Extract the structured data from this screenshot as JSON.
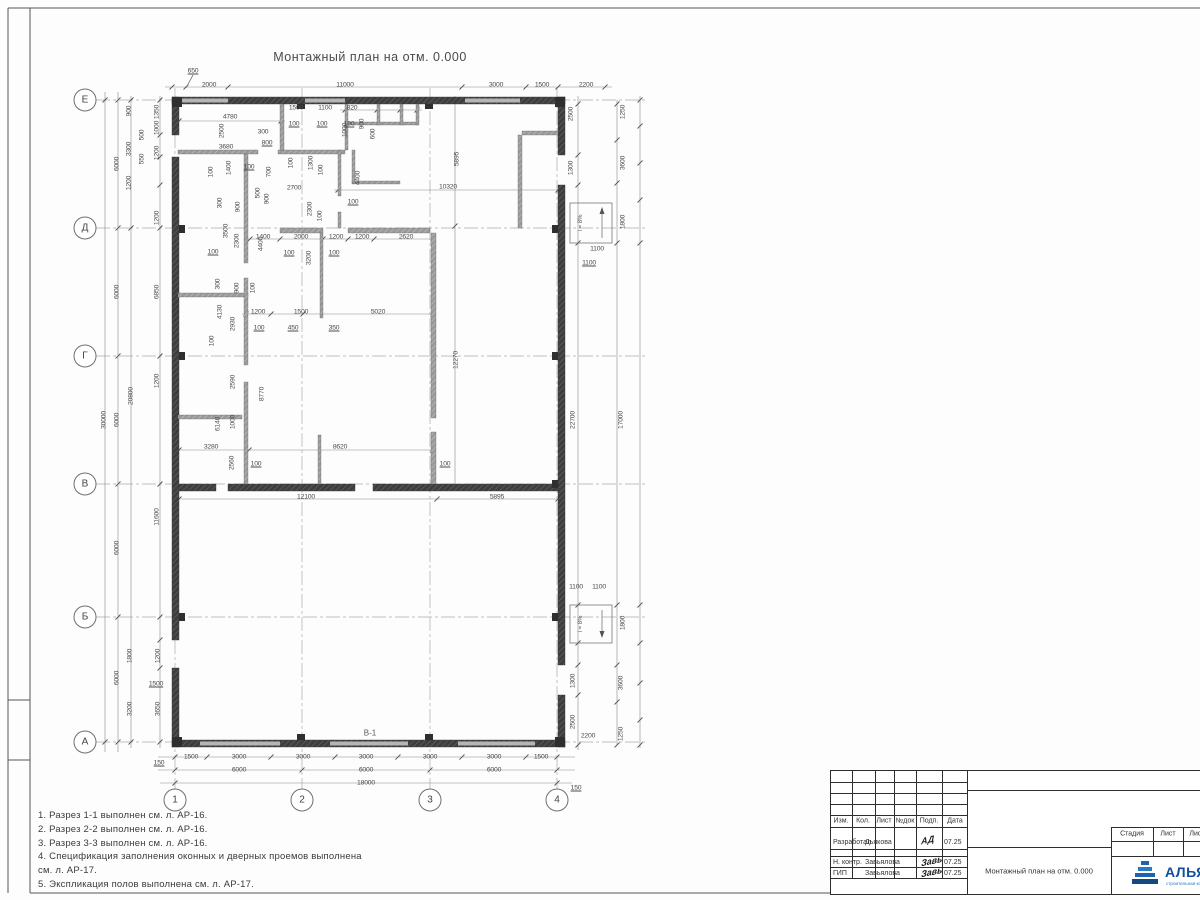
{
  "title": "Монтажный план на отм. 0.000",
  "plan_label": "В-1",
  "ramps": {
    "top": "i = 8%",
    "bottom": "i = 8%"
  },
  "grid": {
    "rows": [
      {
        "label": "Е",
        "y": 100
      },
      {
        "label": "Д",
        "y": 228
      },
      {
        "label": "Г",
        "y": 356
      },
      {
        "label": "В",
        "y": 484
      },
      {
        "label": "Б",
        "y": 617
      },
      {
        "label": "А",
        "y": 742
      }
    ],
    "cols": [
      {
        "label": "1",
        "x": 175
      },
      {
        "label": "2",
        "x": 302
      },
      {
        "label": "3",
        "x": 430
      },
      {
        "label": "4",
        "x": 557
      }
    ]
  },
  "dims": [
    {
      "t": "650",
      "x": 193,
      "y": 71,
      "r": 0,
      "u": 1
    },
    {
      "t": "2000",
      "x": 209,
      "y": 85,
      "r": 0
    },
    {
      "t": "11000",
      "x": 345,
      "y": 85,
      "r": 0
    },
    {
      "t": "3000",
      "x": 496,
      "y": 85,
      "r": 0
    },
    {
      "t": "1500",
      "x": 542,
      "y": 85,
      "r": 0
    },
    {
      "t": "2200",
      "x": 586,
      "y": 85,
      "r": 0
    },
    {
      "t": "1500",
      "x": 296,
      "y": 108,
      "r": 0
    },
    {
      "t": "1100",
      "x": 325,
      "y": 108,
      "r": 0
    },
    {
      "t": "820",
      "x": 352,
      "y": 108,
      "r": 0
    },
    {
      "t": "4780",
      "x": 230,
      "y": 117,
      "r": 0
    },
    {
      "t": "100",
      "x": 294,
      "y": 124,
      "r": 0,
      "u": 1
    },
    {
      "t": "100",
      "x": 322,
      "y": 124,
      "r": 0,
      "u": 1
    },
    {
      "t": "100",
      "x": 349,
      "y": 124,
      "r": 0,
      "u": 1
    },
    {
      "t": "900",
      "x": 362,
      "y": 124,
      "r": 1
    },
    {
      "t": "600",
      "x": 373,
      "y": 134,
      "r": 1
    },
    {
      "t": "2500",
      "x": 222,
      "y": 131,
      "r": 1
    },
    {
      "t": "300",
      "x": 263,
      "y": 132,
      "r": 0
    },
    {
      "t": "800",
      "x": 267,
      "y": 143,
      "r": 0,
      "u": 1
    },
    {
      "t": "3680",
      "x": 226,
      "y": 147,
      "r": 0
    },
    {
      "t": "1000",
      "x": 345,
      "y": 130,
      "r": 1
    },
    {
      "t": "100",
      "x": 291,
      "y": 163,
      "r": 1
    },
    {
      "t": "1300",
      "x": 311,
      "y": 163,
      "r": 1
    },
    {
      "t": "100",
      "x": 321,
      "y": 170,
      "r": 1
    },
    {
      "t": "4400",
      "x": 358,
      "y": 178,
      "r": 1
    },
    {
      "t": "5895",
      "x": 457,
      "y": 159,
      "r": 1
    },
    {
      "t": "10320",
      "x": 448,
      "y": 187,
      "r": 0
    },
    {
      "t": "100",
      "x": 211,
      "y": 172,
      "r": 1
    },
    {
      "t": "1400",
      "x": 229,
      "y": 168,
      "r": 1
    },
    {
      "t": "100",
      "x": 249,
      "y": 167,
      "r": 0,
      "u": 1
    },
    {
      "t": "700",
      "x": 269,
      "y": 172,
      "r": 1
    },
    {
      "t": "2700",
      "x": 294,
      "y": 188,
      "r": 0
    },
    {
      "t": "100",
      "x": 353,
      "y": 202,
      "r": 0,
      "u": 1
    },
    {
      "t": "500",
      "x": 258,
      "y": 193,
      "r": 1
    },
    {
      "t": "900",
      "x": 267,
      "y": 199,
      "r": 1
    },
    {
      "t": "2300",
      "x": 310,
      "y": 209,
      "r": 1
    },
    {
      "t": "100",
      "x": 320,
      "y": 216,
      "r": 1
    },
    {
      "t": "300",
      "x": 220,
      "y": 203,
      "r": 1
    },
    {
      "t": "900",
      "x": 238,
      "y": 207,
      "r": 1
    },
    {
      "t": "3500",
      "x": 226,
      "y": 231,
      "r": 1
    },
    {
      "t": "2300",
      "x": 237,
      "y": 241,
      "r": 1
    },
    {
      "t": "1400",
      "x": 263,
      "y": 237,
      "r": 0
    },
    {
      "t": "2000",
      "x": 301,
      "y": 237,
      "r": 0
    },
    {
      "t": "1200",
      "x": 336,
      "y": 237,
      "r": 0
    },
    {
      "t": "1200",
      "x": 362,
      "y": 237,
      "r": 0
    },
    {
      "t": "2620",
      "x": 406,
      "y": 237,
      "r": 0
    },
    {
      "t": "100",
      "x": 289,
      "y": 253,
      "r": 0,
      "u": 1
    },
    {
      "t": "100",
      "x": 334,
      "y": 253,
      "r": 0,
      "u": 1
    },
    {
      "t": "100",
      "x": 213,
      "y": 252,
      "r": 0,
      "u": 1
    },
    {
      "t": "4400",
      "x": 261,
      "y": 244,
      "r": 1
    },
    {
      "t": "3200",
      "x": 309,
      "y": 258,
      "r": 1
    },
    {
      "t": "300",
      "x": 218,
      "y": 284,
      "r": 1
    },
    {
      "t": "900",
      "x": 237,
      "y": 288,
      "r": 1
    },
    {
      "t": "100",
      "x": 253,
      "y": 288,
      "r": 1
    },
    {
      "t": "4130",
      "x": 220,
      "y": 312,
      "r": 1
    },
    {
      "t": "2930",
      "x": 233,
      "y": 324,
      "r": 1
    },
    {
      "t": "1200",
      "x": 258,
      "y": 312,
      "r": 0
    },
    {
      "t": "1500",
      "x": 301,
      "y": 312,
      "r": 0
    },
    {
      "t": "5020",
      "x": 378,
      "y": 312,
      "r": 0
    },
    {
      "t": "100",
      "x": 259,
      "y": 328,
      "r": 0,
      "u": 1
    },
    {
      "t": "450",
      "x": 293,
      "y": 328,
      "r": 0,
      "u": 1
    },
    {
      "t": "350",
      "x": 334,
      "y": 328,
      "r": 0,
      "u": 1
    },
    {
      "t": "100",
      "x": 212,
      "y": 341,
      "r": 1
    },
    {
      "t": "2590",
      "x": 233,
      "y": 382,
      "r": 1
    },
    {
      "t": "8770",
      "x": 262,
      "y": 394,
      "r": 1
    },
    {
      "t": "6140",
      "x": 218,
      "y": 424,
      "r": 1
    },
    {
      "t": "1000",
      "x": 233,
      "y": 422,
      "r": 1
    },
    {
      "t": "3280",
      "x": 211,
      "y": 447,
      "r": 0
    },
    {
      "t": "8620",
      "x": 340,
      "y": 447,
      "r": 0
    },
    {
      "t": "2560",
      "x": 232,
      "y": 463,
      "r": 1
    },
    {
      "t": "100",
      "x": 256,
      "y": 464,
      "r": 0,
      "u": 1
    },
    {
      "t": "100",
      "x": 445,
      "y": 464,
      "r": 0,
      "u": 1
    },
    {
      "t": "12100",
      "x": 306,
      "y": 497,
      "r": 0
    },
    {
      "t": "5895",
      "x": 497,
      "y": 497,
      "r": 0
    },
    {
      "t": "12270",
      "x": 456,
      "y": 360,
      "r": 1
    },
    {
      "t": "30000",
      "x": 104,
      "y": 420,
      "r": 1
    },
    {
      "t": "6000",
      "x": 117,
      "y": 164,
      "r": 1
    },
    {
      "t": "6000",
      "x": 117,
      "y": 292,
      "r": 1
    },
    {
      "t": "6000",
      "x": 117,
      "y": 420,
      "r": 1
    },
    {
      "t": "6000",
      "x": 117,
      "y": 548,
      "r": 1
    },
    {
      "t": "6000",
      "x": 117,
      "y": 678,
      "r": 1
    },
    {
      "t": "900",
      "x": 129,
      "y": 111,
      "r": 1
    },
    {
      "t": "3300",
      "x": 129,
      "y": 149,
      "r": 1
    },
    {
      "t": "1200",
      "x": 129,
      "y": 183,
      "r": 1
    },
    {
      "t": "20800",
      "x": 131,
      "y": 396,
      "r": 1
    },
    {
      "t": "500",
      "x": 142,
      "y": 135,
      "r": 1
    },
    {
      "t": "550",
      "x": 142,
      "y": 159,
      "r": 1
    },
    {
      "t": "1350",
      "x": 157,
      "y": 112,
      "r": 1
    },
    {
      "t": "1000",
      "x": 157,
      "y": 128,
      "r": 1
    },
    {
      "t": "1200",
      "x": 157,
      "y": 153,
      "r": 1
    },
    {
      "t": "1200",
      "x": 157,
      "y": 218,
      "r": 1
    },
    {
      "t": "6850",
      "x": 157,
      "y": 292,
      "r": 1
    },
    {
      "t": "1200",
      "x": 157,
      "y": 381,
      "r": 1
    },
    {
      "t": "11600",
      "x": 157,
      "y": 517,
      "r": 1
    },
    {
      "t": "1800",
      "x": 130,
      "y": 656,
      "r": 1
    },
    {
      "t": "1200",
      "x": 158,
      "y": 656,
      "r": 1
    },
    {
      "t": "1500",
      "x": 156,
      "y": 684,
      "r": 0,
      "u": 1
    },
    {
      "t": "3200",
      "x": 130,
      "y": 709,
      "r": 1
    },
    {
      "t": "3650",
      "x": 158,
      "y": 709,
      "r": 1
    },
    {
      "t": "150",
      "x": 159,
      "y": 763,
      "r": 0,
      "u": 1
    },
    {
      "t": "1500",
      "x": 191,
      "y": 757,
      "r": 0
    },
    {
      "t": "3000",
      "x": 239,
      "y": 757,
      "r": 0
    },
    {
      "t": "3000",
      "x": 303,
      "y": 757,
      "r": 0
    },
    {
      "t": "3000",
      "x": 366,
      "y": 757,
      "r": 0
    },
    {
      "t": "3000",
      "x": 430,
      "y": 757,
      "r": 0
    },
    {
      "t": "3000",
      "x": 494,
      "y": 757,
      "r": 0
    },
    {
      "t": "1500",
      "x": 541,
      "y": 757,
      "r": 0
    },
    {
      "t": "6000",
      "x": 239,
      "y": 770,
      "r": 0
    },
    {
      "t": "6000",
      "x": 366,
      "y": 770,
      "r": 0
    },
    {
      "t": "6000",
      "x": 494,
      "y": 770,
      "r": 0
    },
    {
      "t": "18000",
      "x": 366,
      "y": 783,
      "r": 0
    },
    {
      "t": "150",
      "x": 576,
      "y": 788,
      "r": 0,
      "u": 1
    },
    {
      "t": "1250",
      "x": 623,
      "y": 112,
      "r": 1
    },
    {
      "t": "2500",
      "x": 571,
      "y": 114,
      "r": 1
    },
    {
      "t": "1300",
      "x": 571,
      "y": 168,
      "r": 1
    },
    {
      "t": "3600",
      "x": 623,
      "y": 163,
      "r": 1
    },
    {
      "t": "1800",
      "x": 623,
      "y": 222,
      "r": 1
    },
    {
      "t": "1100",
      "x": 597,
      "y": 249,
      "r": 0
    },
    {
      "t": "1100",
      "x": 589,
      "y": 263,
      "r": 0,
      "u": 1
    },
    {
      "t": "22700",
      "x": 573,
      "y": 420,
      "r": 1
    },
    {
      "t": "17000",
      "x": 621,
      "y": 420,
      "r": 1
    },
    {
      "t": "1100",
      "x": 576,
      "y": 587,
      "r": 0
    },
    {
      "t": "1100",
      "x": 599,
      "y": 587,
      "r": 0
    },
    {
      "t": "1800",
      "x": 623,
      "y": 623,
      "r": 1
    },
    {
      "t": "1300",
      "x": 573,
      "y": 681,
      "r": 1
    },
    {
      "t": "3600",
      "x": 621,
      "y": 683,
      "r": 1
    },
    {
      "t": "2500",
      "x": 573,
      "y": 722,
      "r": 1
    },
    {
      "t": "2200",
      "x": 588,
      "y": 736,
      "r": 0
    },
    {
      "t": "1250",
      "x": 621,
      "y": 734,
      "r": 1
    }
  ],
  "notes": [
    "1. Разрез 1-1 выполнен см. л. АР-16.",
    "2. Разрез 2-2 выполнен см. л. АР-16.",
    "3. Разрез 3-3 выполнен см. л. АР-16.",
    "4. Спецификация заполнения оконных и дверных проемов выполнена",
    "см. л. АР-17.",
    "5. Экспликация полов выполнена см. л. АР-17."
  ],
  "titleblock": {
    "header_cols": [
      "Изм.",
      "Кол.",
      "Лист",
      "№док",
      "Подп.",
      "Дата"
    ],
    "rows": [
      {
        "role": "Разработал",
        "name": "Дьякова",
        "sig": "АД",
        "date": "07.25"
      },
      {
        "role": "Н. контр.",
        "name": "Завьялова",
        "sig": "Завь",
        "date": "07.25"
      },
      {
        "role": "ГИП",
        "name": "Завьялова",
        "sig": "Завь",
        "date": "07.25"
      }
    ],
    "doc_title": "Монтажный план на отм. 0.000",
    "stage_cols": [
      "Стадия",
      "Лист",
      "Лист"
    ],
    "logo_name": "АЛЬЯНС",
    "logo_subtitle": "строительная компания"
  },
  "colors": {
    "wall": "#3e3e3e",
    "partition": "#9a9a9a",
    "window": "#b5b5b5",
    "dim_text": "#4a4a4a",
    "logo_blue": "#0f4f9e"
  }
}
